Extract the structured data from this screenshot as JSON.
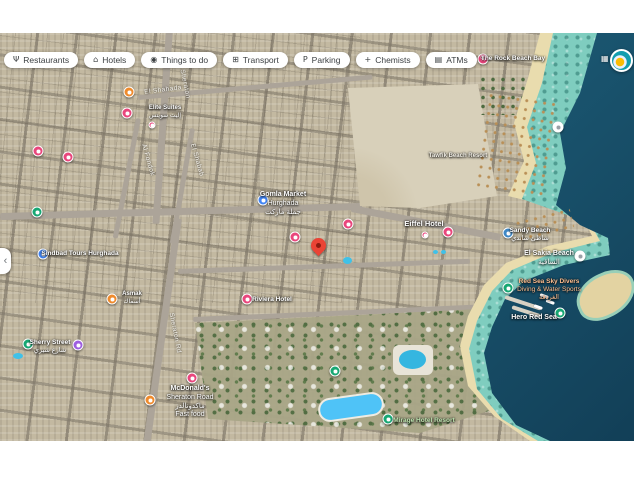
{
  "toolbar": {
    "chips": [
      {
        "label": "Restaurants",
        "icon": "restaurants-icon",
        "glyph": "Ψ"
      },
      {
        "label": "Hotels",
        "icon": "hotels-icon",
        "glyph": "⌂"
      },
      {
        "label": "Things to do",
        "icon": "camera-icon",
        "glyph": "◉"
      },
      {
        "label": "Transport",
        "icon": "transport-icon",
        "glyph": "⊞"
      },
      {
        "label": "Parking",
        "icon": "parking-icon",
        "glyph": "P"
      },
      {
        "label": "Chemists",
        "icon": "chemists-icon",
        "glyph": "+"
      },
      {
        "label": "ATMs",
        "icon": "atm-icon",
        "glyph": "▤"
      }
    ]
  },
  "map": {
    "marker_colors": {
      "restaurant": "#EF8B2D",
      "hotel": "#E9467C",
      "shop": "#4285F4",
      "beach": "#3F88C5",
      "green": "#17A773",
      "purple": "#9E5FE0",
      "white": "#FFFFFF",
      "mini": "#E9467C",
      "percent": "#E9467C"
    },
    "selected_pin": {
      "x": 318,
      "y": 224,
      "color": "#EA4335"
    },
    "markers": [
      {
        "kind": "restaurant",
        "x": 129,
        "y": 59,
        "name": "restaurant-marker"
      },
      {
        "kind": "hotel",
        "x": 127,
        "y": 80,
        "name": "hotel-marker"
      },
      {
        "kind": "hotel",
        "x": 38,
        "y": 118,
        "name": "hotel-marker"
      },
      {
        "kind": "hotel",
        "x": 68,
        "y": 124,
        "name": "hotel-marker"
      },
      {
        "kind": "green",
        "x": 37,
        "y": 179,
        "name": "park-marker"
      },
      {
        "kind": "shop",
        "x": 263,
        "y": 167,
        "name": "supermarket-marker"
      },
      {
        "kind": "hotel",
        "x": 348,
        "y": 191,
        "name": "hotel-marker"
      },
      {
        "kind": "hotel",
        "x": 295,
        "y": 204,
        "name": "hotel-marker"
      },
      {
        "kind": "hotel",
        "x": 448,
        "y": 199,
        "name": "hotel-marker"
      },
      {
        "kind": "mini",
        "x": 425,
        "y": 202,
        "name": "mini-pin"
      },
      {
        "kind": "mini",
        "x": 152,
        "y": 92,
        "name": "mini-pin"
      },
      {
        "kind": "shop",
        "x": 43,
        "y": 221,
        "name": "store-marker"
      },
      {
        "kind": "restaurant",
        "x": 112,
        "y": 266,
        "name": "restaurant-marker"
      },
      {
        "kind": "hotel",
        "x": 247,
        "y": 266,
        "name": "hotel-marker"
      },
      {
        "kind": "green",
        "x": 28,
        "y": 311,
        "name": "park-marker"
      },
      {
        "kind": "purple",
        "x": 78,
        "y": 312,
        "name": "attraction-marker"
      },
      {
        "kind": "hotel",
        "x": 192,
        "y": 345,
        "name": "hotel-marker"
      },
      {
        "kind": "restaurant",
        "x": 150,
        "y": 367,
        "name": "restaurant-marker"
      },
      {
        "kind": "green",
        "x": 335,
        "y": 338,
        "name": "resort-marker"
      },
      {
        "kind": "green",
        "x": 388,
        "y": 386,
        "name": "resort-marker"
      },
      {
        "kind": "beach",
        "x": 508,
        "y": 200,
        "name": "beach-marker"
      },
      {
        "kind": "white",
        "x": 580,
        "y": 223,
        "name": "beach-access-marker"
      },
      {
        "kind": "white",
        "x": 558,
        "y": 94,
        "name": "beach-access-marker"
      },
      {
        "kind": "green",
        "x": 508,
        "y": 255,
        "name": "boat-tour-marker"
      },
      {
        "kind": "green",
        "x": 560,
        "y": 280,
        "name": "boat-tour-marker"
      },
      {
        "kind": "percent",
        "x": 483,
        "y": 26,
        "name": "deal-marker",
        "glyph": "%"
      }
    ],
    "street_labels": [
      {
        "text": "Sheraton",
        "x": 185,
        "y": 51,
        "rot": 78
      },
      {
        "text": "El Shahada",
        "x": 163,
        "y": 57,
        "rot": -7
      },
      {
        "text": "Al Fondok",
        "x": 148,
        "y": 127,
        "rot": 74
      },
      {
        "text": "El Shabab",
        "x": 197,
        "y": 127,
        "rot": 74
      },
      {
        "text": "Sheraton Rd",
        "x": 175,
        "y": 300,
        "rot": 79
      }
    ],
    "poi_labels": [
      {
        "lines": [
          "Gomla Market",
          "Hurghada",
          "جملة ماركت"
        ],
        "x": 283,
        "y": 158,
        "size": 7,
        "color": "#ffffff"
      },
      {
        "lines": [
          "Eiffel Hotel"
        ],
        "x": 424,
        "y": 186,
        "size": 7.5,
        "color": "#ffffff"
      },
      {
        "lines": [
          "Elite Suites",
          "إليت سويتس"
        ],
        "x": 165,
        "y": 72,
        "size": 6,
        "color": "#ffffff"
      },
      {
        "lines": [
          "Sindbad Tours Hurghada"
        ],
        "x": 80,
        "y": 217,
        "size": 6.5,
        "color": "#ffffff"
      },
      {
        "lines": [
          "Asmak",
          "أسماك"
        ],
        "x": 132,
        "y": 258,
        "size": 6,
        "color": "#ffffff"
      },
      {
        "lines": [
          "Riviera Hotel"
        ],
        "x": 272,
        "y": 263,
        "size": 6.5,
        "color": "#ffffff"
      },
      {
        "lines": [
          "McDonald's",
          "Sheraton Road",
          "ماكدونالدز",
          "Fast food"
        ],
        "x": 190,
        "y": 352,
        "size": 7,
        "color": "#ffffff"
      },
      {
        "lines": [
          "Sherry Street",
          "شارع شيري"
        ],
        "x": 50,
        "y": 306,
        "size": 6.5,
        "color": "#ffffff"
      },
      {
        "lines": [
          "Sandy Beach",
          "شاطئ ساندي"
        ],
        "x": 530,
        "y": 194,
        "size": 6.5,
        "color": "#ffffff"
      },
      {
        "lines": [
          "El Sakia Beach",
          "الساقية"
        ],
        "x": 549,
        "y": 217,
        "size": 7,
        "color": "#ffffff"
      },
      {
        "lines": [
          "Red Sea Sky Divers",
          "Diving & Water Sports",
          "الغردقة"
        ],
        "x": 549,
        "y": 245,
        "size": 6.5,
        "color": "#FFBE8F"
      },
      {
        "lines": [
          "Hero Red Sea"
        ],
        "x": 534,
        "y": 281,
        "size": 7,
        "color": "#ffffff"
      },
      {
        "lines": [
          "Mirage Hotel Resort"
        ],
        "x": 424,
        "y": 384,
        "size": 6.5,
        "color": "#BCE3AE"
      },
      {
        "lines": [
          "The Rock Beach Bay"
        ],
        "x": 513,
        "y": 22,
        "size": 6.5,
        "color": "#ffffff"
      },
      {
        "lines": [
          "Tawfik Beach Resort"
        ],
        "x": 458,
        "y": 120,
        "size": 6,
        "color": "#f2efe6"
      }
    ],
    "controls": {
      "back_glyph": "‹",
      "grid_glyph": "▦"
    }
  }
}
